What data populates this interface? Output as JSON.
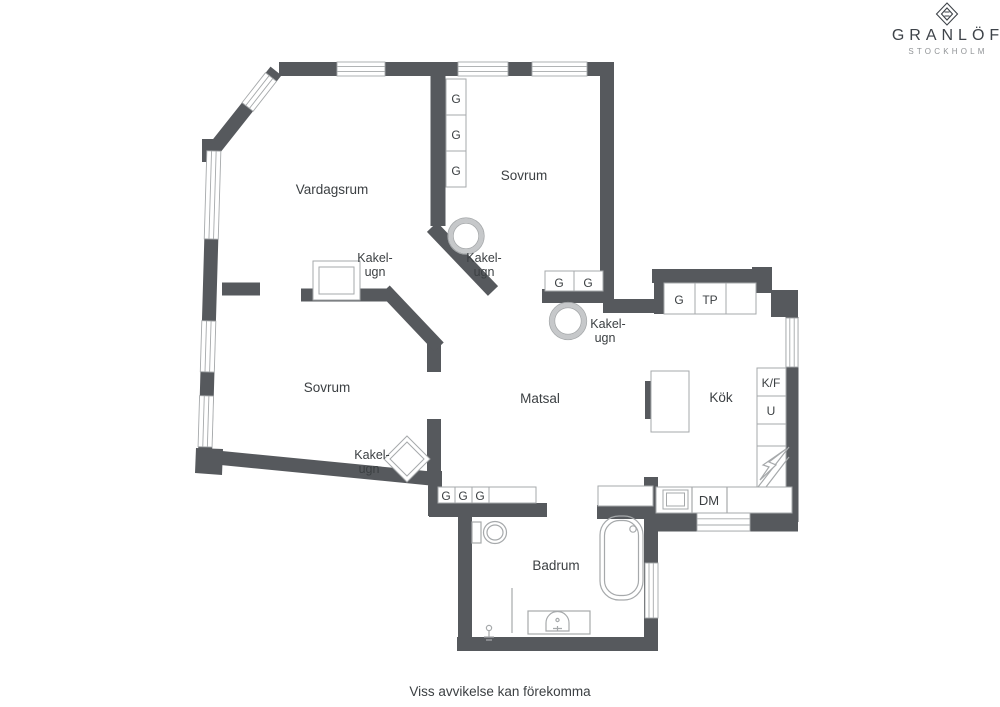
{
  "brand": {
    "name": "GRANLÖF",
    "city": "STOCKHOLM"
  },
  "footer": {
    "disclaimer": "Viss avvikelse kan förekomma"
  },
  "rooms": {
    "living": "Vardagsrum",
    "bedroom_top": "Sovrum",
    "bedroom_left": "Sovrum",
    "dining": "Matsal",
    "kitchen": "Kök",
    "bathroom": "Badrum"
  },
  "stove_label": {
    "line1": "Kakel-",
    "line2": "ugn"
  },
  "fixtures": {
    "wardrobe": "G",
    "tp": "TP",
    "fridge_freezer": "K/F",
    "oven": "U",
    "dishwasher": "DM"
  },
  "colors": {
    "wall": "#56595d",
    "outline": "#a6a9ab",
    "stove_ring": "#c6c8ca",
    "text": "#3c4043",
    "brand_text": "#3e4349",
    "brand_sub": "#909396"
  }
}
